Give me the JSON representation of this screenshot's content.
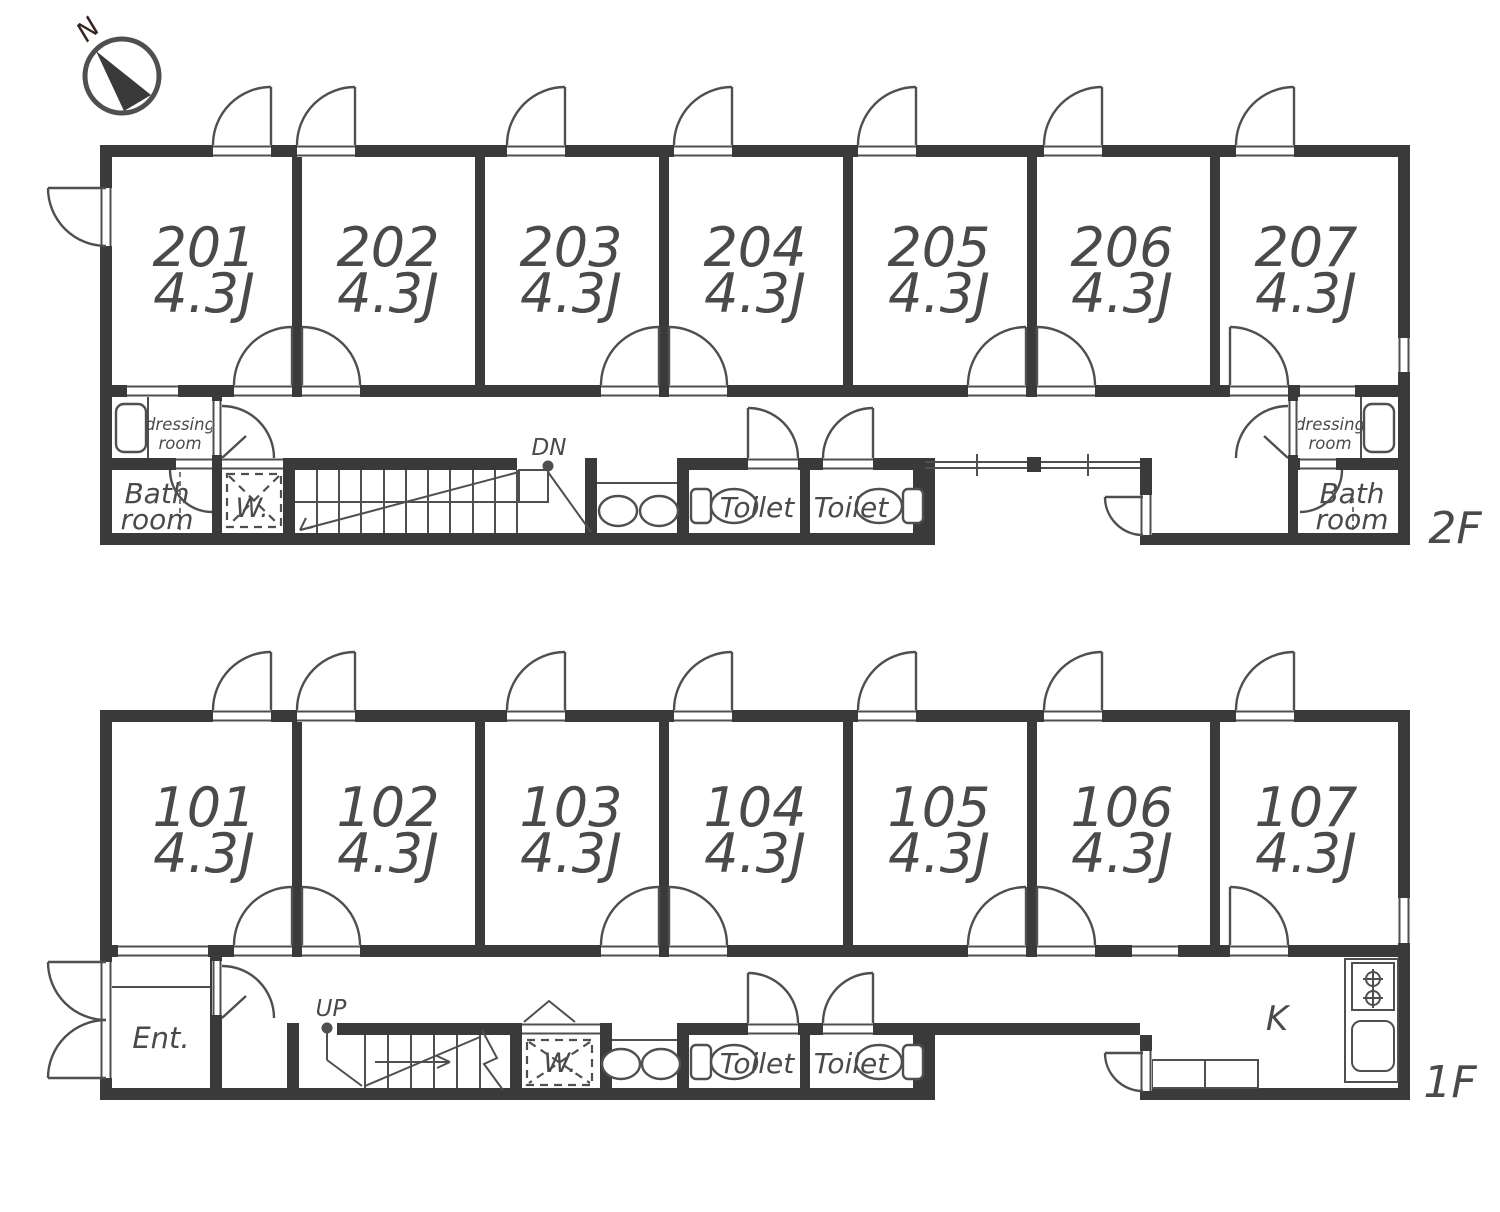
{
  "compass": {
    "north": "N"
  },
  "labels": {
    "dressing_line1": "dressing",
    "dressing_line2": "room",
    "bath_line1": "Bath",
    "bath_line2": "room",
    "toilet": "Toilet",
    "washer": "W.",
    "down": "DN",
    "up": "UP",
    "entrance": "Ent.",
    "kitchen": "K"
  },
  "floors": [
    {
      "name": "2F",
      "rooms": [
        {
          "number": "201",
          "size": "4.3J"
        },
        {
          "number": "202",
          "size": "4.3J"
        },
        {
          "number": "203",
          "size": "4.3J"
        },
        {
          "number": "204",
          "size": "4.3J"
        },
        {
          "number": "205",
          "size": "4.3J"
        },
        {
          "number": "206",
          "size": "4.3J"
        },
        {
          "number": "207",
          "size": "4.3J"
        }
      ]
    },
    {
      "name": "1F",
      "rooms": [
        {
          "number": "101",
          "size": "4.3J"
        },
        {
          "number": "102",
          "size": "4.3J"
        },
        {
          "number": "103",
          "size": "4.3J"
        },
        {
          "number": "104",
          "size": "4.3J"
        },
        {
          "number": "105",
          "size": "4.3J"
        },
        {
          "number": "106",
          "size": "4.3J"
        },
        {
          "number": "107",
          "size": "4.3J"
        }
      ]
    }
  ],
  "colors": {
    "wall": "#3a3a3a",
    "line": "#4f4f4f",
    "text": "#4a4a4a"
  }
}
